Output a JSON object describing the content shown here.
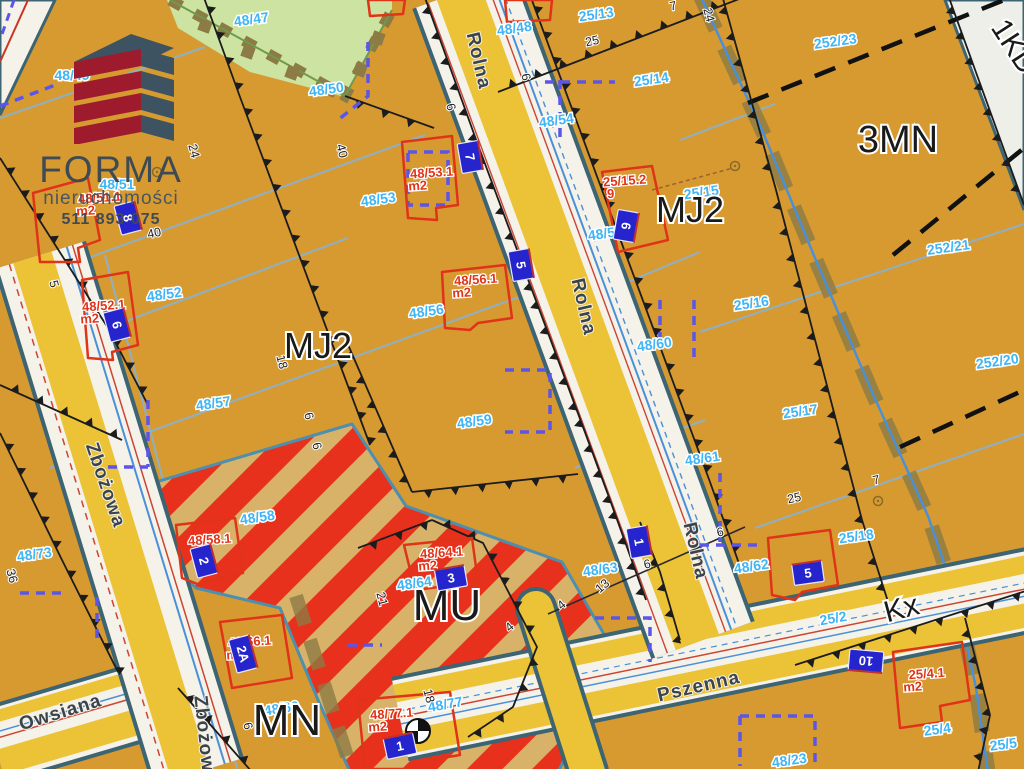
{
  "logo": {
    "title": "FORMA",
    "subtitle": "nieruchomości",
    "phone": "511 893 075"
  },
  "map": {
    "zones": [
      {
        "label": "MJ2",
        "x": 318,
        "y": 358,
        "size": 36,
        "rot": 0
      },
      {
        "label": "MJ2",
        "x": 690,
        "y": 222,
        "size": 36,
        "rot": 0
      },
      {
        "label": "3MN",
        "x": 898,
        "y": 152,
        "size": 38,
        "rot": 0
      },
      {
        "label": "MU",
        "x": 447,
        "y": 620,
        "size": 44,
        "rot": 0
      },
      {
        "label": "MN",
        "x": 287,
        "y": 735,
        "size": 44,
        "rot": 0
      },
      {
        "label": "Kx",
        "x": 904,
        "y": 618,
        "size": 30,
        "rot": -15
      },
      {
        "label": "1KD",
        "x": 1006,
        "y": 52,
        "size": 30,
        "rot": 57
      }
    ],
    "stre§ets_note": "",
    "streets": [
      {
        "name": "Rolna",
        "x": 473,
        "y": 62,
        "rot": 77
      },
      {
        "name": "Rolna",
        "x": 578,
        "y": 308,
        "rot": 77
      },
      {
        "name": "Rolna",
        "x": 690,
        "y": 552,
        "rot": 77
      },
      {
        "name": "Zbożowa",
        "x": 100,
        "y": 487,
        "rot": 71
      },
      {
        "name": "Zbożowa",
        "x": 199,
        "y": 740,
        "rot": 84
      },
      {
        "name": "Owsiana",
        "x": 62,
        "y": 718,
        "rot": -17
      },
      {
        "name": "Pszenna",
        "x": 700,
        "y": 692,
        "rot": -13
      }
    ],
    "parcels": [
      {
        "id": "48/47",
        "x": 252,
        "y": 24,
        "rot": -8
      },
      {
        "id": "48/49",
        "x": 72,
        "y": 80,
        "rot": 0
      },
      {
        "id": "48/50",
        "x": 327,
        "y": 94,
        "rot": -8
      },
      {
        "id": "48/48",
        "x": 515,
        "y": 33,
        "rot": -8
      },
      {
        "id": "25/13",
        "x": 597,
        "y": 19,
        "rot": -8
      },
      {
        "id": "252/23",
        "x": 836,
        "y": 46,
        "rot": -8
      },
      {
        "id": "25/14",
        "x": 652,
        "y": 84,
        "rot": -8
      },
      {
        "id": "48/51",
        "x": 117,
        "y": 189,
        "rot": 0
      },
      {
        "id": "48/54",
        "x": 557,
        "y": 125,
        "rot": -8
      },
      {
        "id": "48/53",
        "x": 379,
        "y": 204,
        "rot": -8
      },
      {
        "id": "25/15",
        "x": 702,
        "y": 197,
        "rot": -8
      },
      {
        "id": "48/55",
        "x": 606,
        "y": 238,
        "rot": -8
      },
      {
        "id": "252/21",
        "x": 949,
        "y": 252,
        "rot": -8
      },
      {
        "id": "48/52",
        "x": 165,
        "y": 299,
        "rot": -8
      },
      {
        "id": "25/16",
        "x": 752,
        "y": 308,
        "rot": -8
      },
      {
        "id": "48/56",
        "x": 427,
        "y": 316,
        "rot": -8
      },
      {
        "id": "48/60",
        "x": 655,
        "y": 349,
        "rot": -8
      },
      {
        "id": "252/20",
        "x": 998,
        "y": 366,
        "rot": -8
      },
      {
        "id": "48/57",
        "x": 214,
        "y": 408,
        "rot": -8
      },
      {
        "id": "25/17",
        "x": 801,
        "y": 416,
        "rot": -8
      },
      {
        "id": "48/59",
        "x": 475,
        "y": 426,
        "rot": -8
      },
      {
        "id": "48/61",
        "x": 703,
        "y": 463,
        "rot": -8
      },
      {
        "id": "48/58",
        "x": 258,
        "y": 522,
        "rot": -8
      },
      {
        "id": "25/18",
        "x": 857,
        "y": 541,
        "rot": -8
      },
      {
        "id": "48/73",
        "x": 35,
        "y": 559,
        "rot": -8
      },
      {
        "id": "48/62",
        "x": 752,
        "y": 571,
        "rot": -8
      },
      {
        "id": "48/63",
        "x": 601,
        "y": 574,
        "rot": -8
      },
      {
        "id": "48/64",
        "x": 415,
        "y": 588,
        "rot": -8
      },
      {
        "id": "25/2",
        "x": 834,
        "y": 623,
        "rot": -10
      },
      {
        "id": "48/66",
        "x": 282,
        "y": 713,
        "rot": -8
      },
      {
        "id": "48/77",
        "x": 446,
        "y": 709,
        "rot": -10
      },
      {
        "id": "25/4",
        "x": 938,
        "y": 734,
        "rot": -8
      },
      {
        "id": "48/23",
        "x": 790,
        "y": 765,
        "rot": -8
      },
      {
        "id": "25/5",
        "x": 1004,
        "y": 749,
        "rot": -8
      }
    ],
    "buildings": [
      {
        "id": "48/51.1",
        "sub": "m2",
        "x": 100,
        "y": 202
      },
      {
        "id": "48/52.1",
        "sub": "m2",
        "x": 104,
        "y": 310
      },
      {
        "id": "48/53.1",
        "sub": "m2",
        "x": 432,
        "y": 177
      },
      {
        "id": "25/15.2",
        "sub": "9",
        "x": 625,
        "y": 185
      },
      {
        "id": "48/56.1",
        "sub": "m2",
        "x": 476,
        "y": 284
      },
      {
        "id": "48/58.1",
        "sub": "",
        "x": 210,
        "y": 544
      },
      {
        "id": "48/64.1",
        "sub": "m2",
        "x": 442,
        "y": 557
      },
      {
        "id": "48/66.1",
        "sub": "m2",
        "x": 250,
        "y": 646
      },
      {
        "id": "48/77.1",
        "sub": "m2",
        "x": 392,
        "y": 718
      },
      {
        "id": "25/4.1",
        "sub": "m2",
        "x": 927,
        "y": 678
      }
    ],
    "markers": [
      {
        "no": "8",
        "x": 128,
        "y": 218,
        "rot": 75
      },
      {
        "no": "6",
        "x": 117,
        "y": 325,
        "rot": 75
      },
      {
        "no": "7",
        "x": 470,
        "y": 157,
        "rot": 80
      },
      {
        "no": "5",
        "x": 521,
        "y": 265,
        "rot": 80
      },
      {
        "no": "6",
        "x": 626,
        "y": 226,
        "rot": 100
      },
      {
        "no": "2",
        "x": 204,
        "y": 561,
        "rot": 75
      },
      {
        "no": "2A",
        "x": 243,
        "y": 654,
        "rot": 75
      },
      {
        "no": "3",
        "x": 451,
        "y": 578,
        "rot": -10
      },
      {
        "no": "1",
        "x": 400,
        "y": 746,
        "rot": -12
      },
      {
        "no": "1",
        "x": 639,
        "y": 542,
        "rot": 80
      },
      {
        "no": "5",
        "x": 808,
        "y": 573,
        "rot": -8
      },
      {
        "no": "10",
        "x": 866,
        "y": 661,
        "rot": 185
      }
    ],
    "measurements": [
      {
        "v": "19",
        "x": 146,
        "y": 50,
        "rot": 75
      },
      {
        "v": "24",
        "x": 190,
        "y": 152,
        "rot": 75
      },
      {
        "v": "40",
        "x": 155,
        "y": 237,
        "rot": -12
      },
      {
        "v": "40",
        "x": 338,
        "y": 152,
        "rot": 75
      },
      {
        "v": "25",
        "x": 593,
        "y": 45,
        "rot": -12
      },
      {
        "v": "7",
        "x": 674,
        "y": 10,
        "rot": -12
      },
      {
        "v": "24",
        "x": 705,
        "y": 16,
        "rot": 75
      },
      {
        "v": "6",
        "x": 522,
        "y": 78,
        "rot": 75
      },
      {
        "v": "6",
        "x": 447,
        "y": 108,
        "rot": 75
      },
      {
        "v": "5",
        "x": 50,
        "y": 285,
        "rot": 75
      },
      {
        "v": "18",
        "x": 278,
        "y": 363,
        "rot": 75
      },
      {
        "v": "6",
        "x": 305,
        "y": 417,
        "rot": 75
      },
      {
        "v": "6",
        "x": 313,
        "y": 447,
        "rot": 75
      },
      {
        "v": "25",
        "x": 795,
        "y": 502,
        "rot": -12
      },
      {
        "v": "7",
        "x": 877,
        "y": 484,
        "rot": -12
      },
      {
        "v": "6",
        "x": 721,
        "y": 536,
        "rot": -12
      },
      {
        "v": "6",
        "x": 648,
        "y": 568,
        "rot": -12
      },
      {
        "v": "13",
        "x": 605,
        "y": 589,
        "rot": -40
      },
      {
        "v": "4",
        "x": 564,
        "y": 608,
        "rot": -40
      },
      {
        "v": "4",
        "x": 512,
        "y": 630,
        "rot": -40
      },
      {
        "v": "21",
        "x": 378,
        "y": 600,
        "rot": 75
      },
      {
        "v": "18",
        "x": 425,
        "y": 697,
        "rot": 75
      },
      {
        "v": "36",
        "x": 8,
        "y": 577,
        "rot": 75
      },
      {
        "v": "6",
        "x": 244,
        "y": 727,
        "rot": 75
      }
    ]
  },
  "colors": {
    "background": "#d79a31",
    "road_yellow": "#ecc336",
    "road_white": "#f5f2ea",
    "casing": "#3c6472",
    "green_area": "#cde3a1",
    "hatch_red": "#e8311c",
    "hatch_tan": "#d9b269",
    "marker_blue": "#2524cd",
    "parcel_label": "#3fb5f5",
    "building_label": "#e03418",
    "zone_label": "#1a1a1a",
    "street_label": "#3b444a",
    "setback_blue": "#5b55e8",
    "cadastral_blue": "#8fb0c4",
    "utility_blue": "#4a90d8",
    "shadow_olive": "#8c7b44",
    "kx_gray": "#d8d7d2",
    "logo_red": "#9e1b2e",
    "logo_slate": "#3d5361"
  }
}
